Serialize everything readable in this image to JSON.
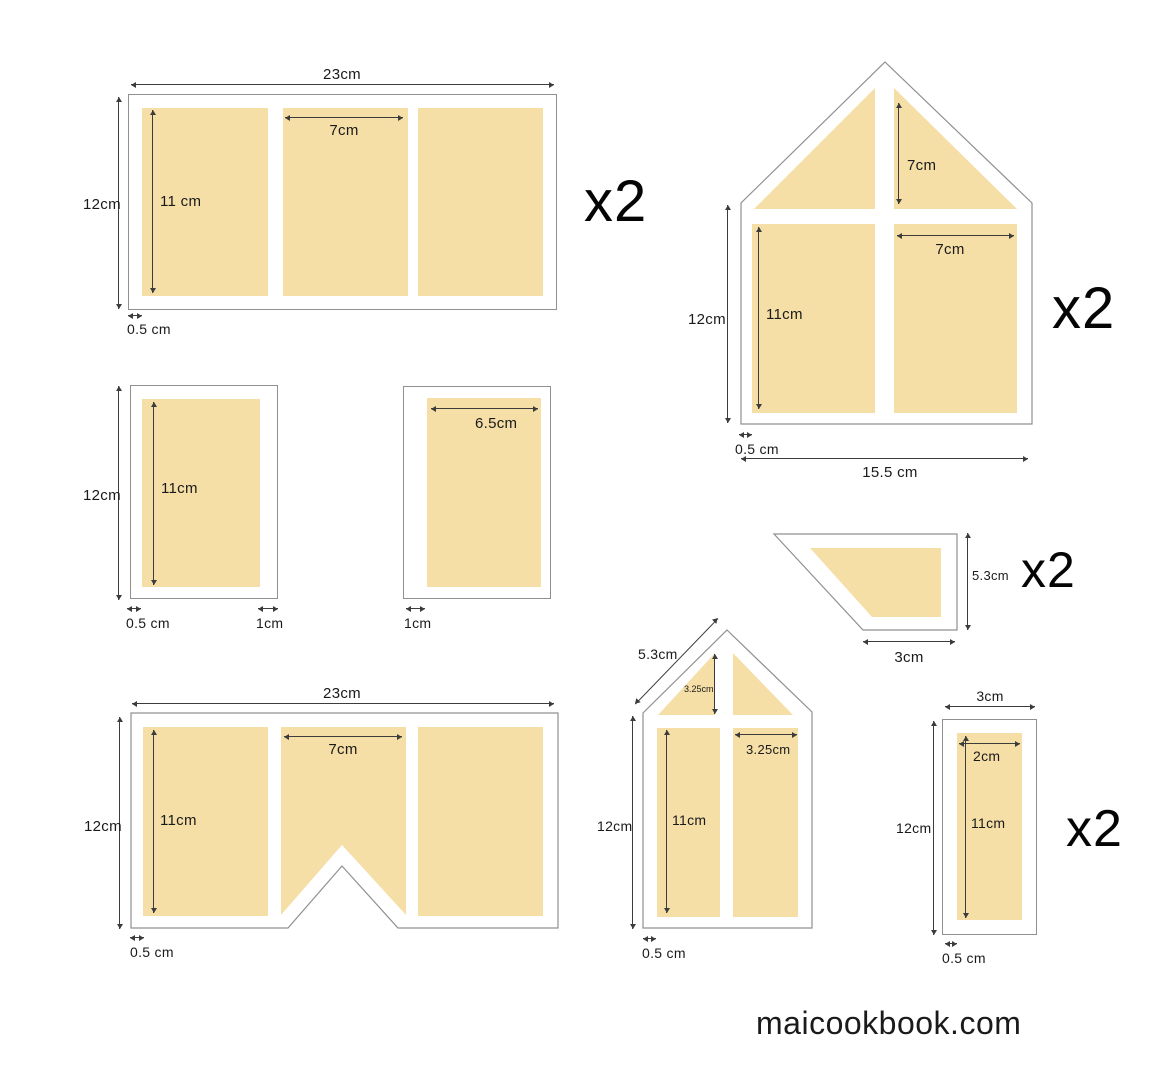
{
  "colors": {
    "panel": "#F5DFA7",
    "outline": "#909090",
    "dimension_line": "#3C3C3C",
    "text": "#1A1A1A",
    "background": "#FFFFFF"
  },
  "footer": {
    "brand": "maicookbook.com"
  },
  "shapes": {
    "large_wall_top": {
      "count": "x2",
      "dims": {
        "width": "23cm",
        "height": "12cm",
        "panel_height": "11 cm",
        "panel_width": "7cm",
        "edge_gap": "0.5 cm"
      }
    },
    "gable_wall": {
      "count": "x2",
      "dims": {
        "height": "12cm",
        "gable_panel_height": "7cm",
        "panel_height": "11cm",
        "panel_width": "7cm",
        "edge_gap": "0.5 cm",
        "width": "15.5 cm"
      }
    },
    "small_panel_left": {
      "dims": {
        "height": "12cm",
        "panel_height": "11cm",
        "edge_gap": "0.5 cm",
        "side_gap": "1cm"
      }
    },
    "small_panel_right": {
      "dims": {
        "panel_width": "6.5cm",
        "side_gap": "1cm"
      }
    },
    "chimney_side": {
      "count": "x2",
      "dims": {
        "height": "5.3cm",
        "width": "3cm"
      }
    },
    "notched_wall": {
      "dims": {
        "width": "23cm",
        "height": "12cm",
        "panel_height": "11cm",
        "panel_width": "7cm",
        "edge_gap": "0.5 cm"
      }
    },
    "narrow_gable": {
      "dims": {
        "roof_edge": "5.3cm",
        "gable_panel_height": "3.25cm",
        "height": "12cm",
        "panel_height": "11cm",
        "panel_width": "3.25cm",
        "edge_gap": "0.5 cm"
      }
    },
    "narrow_strip": {
      "count": "x2",
      "dims": {
        "width": "3cm",
        "height": "12cm",
        "panel_width": "2cm",
        "panel_height": "11cm",
        "edge_gap": "0.5 cm"
      }
    }
  }
}
